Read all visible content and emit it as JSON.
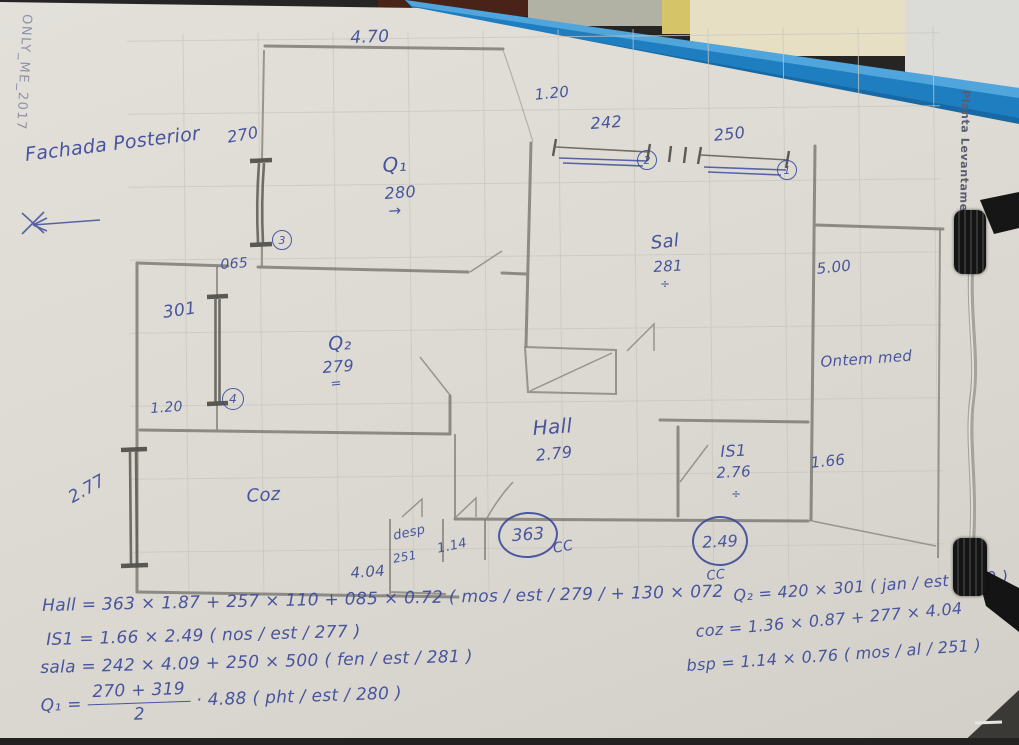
{
  "photo": {
    "side_texts": {
      "watermark": "ONLY_ME_2017",
      "plan_title": "Planta Levantamento",
      "note_back": "Fachada Posterior"
    }
  },
  "plan_labels": {
    "dim_470": "4.70",
    "dim_120_top": "1.20",
    "win_242": "242",
    "win_242_id": "2",
    "win_250": "250",
    "win_250_id": "1",
    "win_270": "270",
    "win_270_id": "3",
    "dim_065": "065",
    "win_301": "301",
    "win_301_id": "4",
    "dim_120_left": "1.20",
    "win_277": "2.77",
    "room_q1": "Q₁",
    "room_q1_h": "280",
    "room_q2": "Q₂",
    "room_q2_h": "279",
    "room_sala": "Sal",
    "room_sala_h": "281",
    "dim_500": "5.00",
    "note_right": "Ontem med",
    "room_hall": "Hall",
    "room_hall_h": "2.79",
    "room_is1": "IS1",
    "room_is1_h": "2.76",
    "dim_166": "1.66",
    "cc_363": "363",
    "cc_363_label": "CC",
    "cc_249": "2.49",
    "cc_249_label": "CC",
    "room_desp": "desp",
    "room_desp_h": "251",
    "dim_114": "1.14",
    "room_coz": "Coz",
    "dim_404": "4.04",
    "mark_arrow": "→",
    "mark_equals": "=",
    "mark_div_sala": "÷",
    "mark_div_is1": "÷"
  },
  "formulas": {
    "hall": "Hall = 363 × 1.87 + 257 × 110 + 085 × 0.72 ( mos / est / 279 / + 130 × 072",
    "q2": "Q₂ = 420 × 301 ( jan / est / 279 )",
    "is1": "IS1 = 1.66 × 2.49 ( nos / est / 277 )",
    "coz": "coz = 1.36 × 0.87 + 277 × 4.04",
    "sala": "sala = 242 × 4.09 + 250 × 500 ( fen / est / 281 )",
    "bsp": "bsp = 1.14 × 0.76 ( mos / al / 251 )",
    "q1_lead": "Q₁ =",
    "q1_num": "270 + 319",
    "q1_den": "2",
    "q1_rest": "· 4.88  ( pht / est / 280 )"
  }
}
